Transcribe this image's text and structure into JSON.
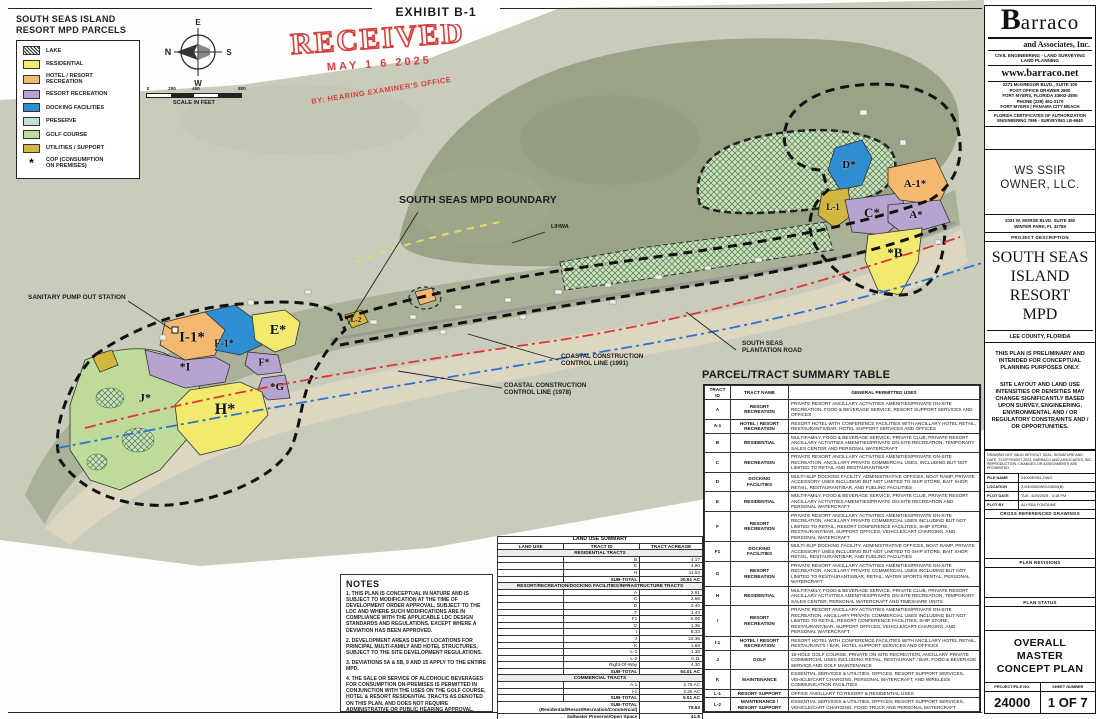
{
  "exhibit_title": "EXHIBIT B-1",
  "stamp": {
    "word": "RECEIVED",
    "date": "MAY 1 6 2025",
    "by_line": "BY: HEARING EXAMINER'S OFFICE"
  },
  "colors": {
    "residential": "#f1ea6e",
    "hotel_resort": "#f4b870",
    "resort_recreation": "#b7a3d0",
    "docking": "#2e8ed2",
    "preserve": "#c2e2cd",
    "golf": "#bedb9a",
    "utilities": "#d3b63f",
    "stamp_red": "#d64040",
    "cccl_1991_red": "#e03636",
    "cccl_1978_blue": "#2f6fd6"
  },
  "legend": {
    "title": "SOUTH SEAS ISLAND\nRESORT MPD PARCELS",
    "items": [
      {
        "label": "LAKE",
        "key": "lake",
        "hatch": true
      },
      {
        "label": "RESIDENTIAL",
        "key": "residential"
      },
      {
        "label": "HOTEL / RESORT\nRECREATION",
        "key": "hotel_resort"
      },
      {
        "label": "RESORT RECREATION",
        "key": "resort_recreation"
      },
      {
        "label": "DOCKING FACILITIES",
        "key": "docking"
      },
      {
        "label": "PRESERVE",
        "key": "preserve"
      },
      {
        "label": "GOLF COURSE",
        "key": "golf"
      },
      {
        "label": "UTILITIES / SUPPORT",
        "key": "utilities"
      }
    ],
    "cop_symbol": "*",
    "cop_label": "COP (CONSUMPTION\nON PREMISES)"
  },
  "compass": {
    "n": "N",
    "e": "E",
    "s": "S",
    "w": "W"
  },
  "scalebar": {
    "ticks": [
      "0",
      "200",
      "400",
      "800"
    ],
    "caption": "SCALE IN FEET"
  },
  "map": {
    "callouts": [
      {
        "id": "mpd-boundary",
        "text": "SOUTH SEAS MPD BOUNDARY"
      },
      {
        "id": "lihwa",
        "text": "LIHWA"
      },
      {
        "id": "sanitary-pump",
        "text": "SANITARY PUMP OUT STATION"
      },
      {
        "id": "cccl-1991",
        "text": "COASTAL CONSTRUCTION\nCONTROL LINE (1991)"
      },
      {
        "id": "cccl-1978",
        "text": "COASTAL CONSTRUCTION\nCONTROL LINE (1978)"
      },
      {
        "id": "plantation-road",
        "text": "SOUTH SEAS\nPLANTATION ROAD"
      }
    ],
    "parcel_labels": [
      "I-1*",
      "F-1*",
      "*I",
      "E*",
      "F*",
      "*G",
      "H*",
      "J*",
      "L-2",
      "D*",
      "L-1",
      "C*",
      "A-1*",
      "A*",
      "*B"
    ]
  },
  "notes": {
    "title": "NOTES",
    "items": [
      "1. THIS PLAN IS CONCEPTUAL IN NATURE AND IS SUBJECT TO MODIFICATION AT THE TIME OF DEVELOPMENT ORDER APPROVAL, SUBJECT TO THE LDC AND WHERE SUCH MODIFICATIONS ARE IN COMPLIANCE WITH THE APPLICABLE LDC DESIGN STANDARDS AND REGULATIONS, EXCEPT WHERE A DEVIATION HAS BEEN APPROVED.",
      "2. DEVELOPMENT AREAS DEPICT LOCATIONS FOR PRINCIPAL MULTI-FAMILY AND HOTEL STRUCTURES, SUBJECT TO THE SITE DEVELOPMENT REGULATIONS.",
      "3. DEVIATIONS 5A & 5B, 9 AND 15 APPLY TO THE ENTIRE MPD.",
      "4. THE SALE OR SERVICE OF ALCOHOLIC BEVERAGES FOR CONSUMPTION ON-PREMISES IS PERMITTED IN CONJUNCTION WITH THE USES ON THE GOLF COURSE, HOTEL & RESORT RESIDENTIAL TRACTS AS DENOTED ON THIS PLAN, AND DOES NOT REQUIRE ADMINISTRATIVE OR PUBLIC HEARING APPROVAL."
    ]
  },
  "land_use_summary": {
    "title": "LAND USE SUMMARY",
    "columns": [
      "LAND USE",
      "TRACT ID",
      "TRACT ACREAGE"
    ],
    "sections": [
      {
        "header": "RESIDENTIAL TRACTS",
        "rows": [
          [
            "B",
            "4.17"
          ],
          [
            "E",
            "4.90"
          ],
          [
            "H",
            "11.54"
          ]
        ],
        "subtotal_label": "SUB-TOTAL",
        "subtotal": "20.61 AC"
      },
      {
        "header": "RESORT/RECREATION/DOCKING FACILITIES/INFRASTRUCTURE TRACTS",
        "rows": [
          [
            "A",
            "2.91"
          ],
          [
            "C",
            "2.68"
          ],
          [
            "D",
            "2.40"
          ],
          [
            "F",
            "1.44"
          ],
          [
            "F1",
            "5.06"
          ],
          [
            "G",
            "1.36"
          ],
          [
            "I",
            "8.33"
          ],
          [
            "J",
            "22.36"
          ],
          [
            "K",
            "1.68"
          ],
          [
            "L-1",
            "1.38"
          ],
          [
            "L-2",
            "0.11"
          ],
          [
            "Right-Of-Way",
            "4.30"
          ]
        ],
        "subtotal_label": "SUB-TOTAL",
        "subtotal": "54.01 AC"
      },
      {
        "header": "COMMERCIAL TRACTS",
        "rows": [
          [
            "A-1",
            "2.76 AC"
          ],
          [
            "I-1",
            "2.25 AC"
          ]
        ],
        "subtotal_label": "SUB-TOTAL",
        "subtotal": "5.01 AC"
      }
    ],
    "totals": [
      {
        "label": "SUB-TOTAL\n(Residential/Resort/Recreation/Commercial)",
        "value": "79.63"
      },
      {
        "label": "Saltwater Preserve/Open Space",
        "value": "41.8"
      },
      {
        "label": "MPD TOTAL",
        "value": "121+/- AC"
      }
    ]
  },
  "parcel_table": {
    "title": "PARCEL/TRACT SUMMARY TABLE",
    "columns": [
      "TRACT\nID",
      "TRACT NAME",
      "GENERAL PERMITTED USES"
    ],
    "rows": [
      [
        "A",
        "RESORT\nRECREATION",
        "PRIVATE RESORT ANCILLARY ACTIVITIES AMENITIES/PRIVATE ON-SITE RECREATION, FOOD & BEVERAGE SERVICE, RESORT SUPPORT SERVICES AND OFFICES"
      ],
      [
        "A-1",
        "HOTEL / RESORT\nRECREATION",
        "RESORT HOTEL WITH CONFERENCE FACILITIES WITH ANCILLARY HOTEL RETAIL, RESTAURANTS/BAR, HOTEL SUPPORT SERVICES AND OFFICES"
      ],
      [
        "B",
        "RESIDENTIAL",
        "MULTIFAMILY, FOOD & BEVERAGE SERVICE, PRIVATE CLUB, PRIVATE RESORT ANCILLARY ACTIVITIES AMENITIES/PRIVATE ON-SITE RECREATION, TEMPORARY SALES CENTER AND PERSONAL WATERCRAFT"
      ],
      [
        "C",
        "RECREATION",
        "PRIVATE RESORT ANCILLARY ACTIVITIES AMENITIES/PRIVATE ON-SITE RECREATION, ANCILLARY PRIVATE COMMERCIAL USES, INCLUDING BUT NOT LIMITED TO RETAIL AND RESTAURANT/BAR"
      ],
      [
        "D",
        "DOCKING\nFACILITIES",
        "MULTI-SLIP DOCKING FACILITY, ADMINISTRATIVE OFFICES, BOAT RAMP, PRIVATE ACCESSORY USES INCLUDING BUT NOT LIMITED TO SHIP STORE, BAIT SHOP, RETAIL, RESTAURANT/BAR, AND FUELING FACILITIES"
      ],
      [
        "E",
        "RESIDENTIAL",
        "MULTIFAMILY, FOOD & BEVERAGE SERVICE, PRIVATE CLUB, PRIVATE RESORT ANCILLARY ACTIVITIES AMENITIES/PRIVATE ON-SITE RECREATION AND PERSONAL WATERCRAFT"
      ],
      [
        "F",
        "RESORT\nRECREATION",
        "PRIVATE RESORT ANCILLARY ACTIVITIES AMENITIES/PRIVATE ON-SITE RECREATION, ANCILLARY PRIVATE COMMERCIAL USES INCLUDING BUT NOT LIMITED TO RETAIL, RESORT CONFERENCE FACILITIES, SHIP STORE, RESTAURANT/BAR, SUPPORT OFFICES, VEHICLE/CART CHARGING, AND PERSONAL WATERCRAFT"
      ],
      [
        "F1",
        "DOCKING\nFACILITIES",
        "MULTI-SLIP DOCKING FACILITY, ADMINISTRATIVE OFFICES, BOAT RAMP, PRIVATE ACCESSORY USES INCLUDING BUT NOT LIMITED TO SHIP STORE, BAIT SHOP, RETAIL, RESTAURANT/BAR, AND FUELING FACILITIES"
      ],
      [
        "G",
        "RESORT\nRECREATION",
        "PRIVATE RESORT ANCILLARY ACTIVITIES AMENITIES/PRIVATE ON-SITE RECREATION, ANCILLARY PRIVATE COMMERCIAL USES INCLUDING BUT NOT LIMITED TO RESTAURANTS/BAR, RETAIL, WATER SPORTS RENTAL, PERSONAL WATERCRAFT"
      ],
      [
        "H",
        "RESIDENTIAL",
        "MULTIFAMILY, FOOD & BEVERAGE SERVICE, PRIVATE CLUB, PRIVATE RESORT ANCILLARY ACTIVITIES AMENITIES/PRIVATE ON-SITE RECREATION, TEMPORARY SALES CENTER, PERSONAL WATERCRAFT AND TIMESHARE UNITS"
      ],
      [
        "I",
        "RESORT\nRECREATION",
        "PRIVATE RESORT ANCILLARY ACTIVITIES AMENITIES/PRIVATE ON-SITE RECREATION, ANCILLARY PRIVATE COMMERCIAL USES INCLUDING BUT NOT LIMITED TO RETAIL, RESORT CONFERENCE FACILITIES, SHIP STORE, RESTAURANT/BAR, SUPPORT OFFICES, VEHICLE/CART CHARGING, AND PERSONAL WATERCRAFT"
      ],
      [
        "I-1",
        "HOTEL / RESORT\nRECREATION",
        "RESORT HOTEL WITH CONFERENCE FACILITIES WITH ANCILLARY HOTEL RETAIL, RESTAURANTS / BAR, HOTEL SUPPORT SERVICES AND OFFICES"
      ],
      [
        "J",
        "GOLF",
        "18-HOLE GOLF COURSE, PRIVATE ON-SITE RECREATION, ANCILLARY PRIVATE COMMERCIAL USES INCLUDING RETAIL, RESTAURANT / BAR, FOOD & BEVERAGE SERVICE AND GOLF MAINTENANCE"
      ],
      [
        "K",
        "MAINTENANCE",
        "ESSENTIAL SERVICES & UTILITIES, OFFICES, RESORT SUPPORT SERVICES, VEHICLE/CART CHARGING, PERSONAL WATERCRAFT, AND WIRELESS COMMUNICATION FACILITIES"
      ],
      [
        "L-1",
        "RESORT SUPPORT",
        "OFFICE ANCILLARY TO RESORT & RESIDENTIAL USES"
      ],
      [
        "L-2",
        "MAINTENANCE /\nRESORT SUPPORT",
        "ESSENTIAL SERVICES & UTILITIES, OFFICES, RESORT SUPPORT SERVICES, VEHICLE/CART CHARGING, FOOD TRUCK AND PERSONAL WATERCRAFT"
      ]
    ]
  },
  "title_block": {
    "firm": {
      "logo_initial": "B",
      "logo_rest": "arraco",
      "sub": "and Associates, Inc.",
      "services": "CIVIL ENGINEERING - LAND SURVEYING LAND PLANNING",
      "website": "www.barraco.net",
      "address": [
        "2271 McGREGOR BLVD., SUITE 100",
        "POST OFFICE DRAWER 2800",
        "FORT MYERS, FLORIDA 33902-2800",
        "PHONE (239) 461-3170",
        "FORT MYERS | PANAMA CITY BEACH"
      ],
      "certs": "FLORIDA CERTIFICATES OF AUTHORIZATION ENGINEERING 7995 - SURVEYING LB-6940"
    },
    "owner": {
      "name": "WS SSIR\nOWNER, LLC.",
      "address1": "1031 W. MORSE BLVD. SUITE 350",
      "address2": "WINTER PARK, FL 32789"
    },
    "project_description_label": "PROJECT DESCRIPTION",
    "project_name": "SOUTH SEAS\nISLAND\nRESORT\nMPD",
    "project_location": "LEE COUNTY, FLORIDA",
    "disclaimer1": "THIS PLAN IS PRELIMINARY AND INTENDED FOR CONCEPTUAL PLANNING PURPOSES ONLY.",
    "disclaimer2": "SITE LAYOUT AND LAND USE INTENSITIES OR DENSITIES MAY CHANGE SIGNIFICANTLY BASED UPON SURVEY, ENGINEERING, ENVIRONMENTAL AND / OR REGULATORY CONSTRAINTS AND / OR OPPORTUNITIES.",
    "copyright": "DRAWING NOT VALID WITHOUT SEAL, SIGNATURE AND DATE. ©COPYRIGHT 2023, BARRACO AND ASSOCIATES, INC. REPRODUCTION, CHANGES OR ASSIGNMENTS ARE PROHIBITED.",
    "file_rows": [
      {
        "label": "FILE NAME",
        "value": "24000EXB1.DWG"
      },
      {
        "label": "LOCATION",
        "value": "J:\\24000\\DWG\\24000(B)"
      },
      {
        "label": "PLOT DATE",
        "value": "TUE, 4/29/2025 - 3:18 PM"
      },
      {
        "label": "PLOT BY",
        "value": "ALYSSA FONTAINE"
      }
    ],
    "cross_ref_label": "CROSS REFERENCED DRAWINGS",
    "plan_revisions_label": "PLAN REVISIONS",
    "plan_status_label": "PLAN STATUS",
    "sheet_title": "OVERALL\nMASTER\nCONCEPT PLAN",
    "project_no_label": "PROJECT/FILE NO.",
    "project_no": "24000",
    "sheet_no_label": "SHEET NUMBER",
    "sheet_no": "1 OF 7"
  }
}
